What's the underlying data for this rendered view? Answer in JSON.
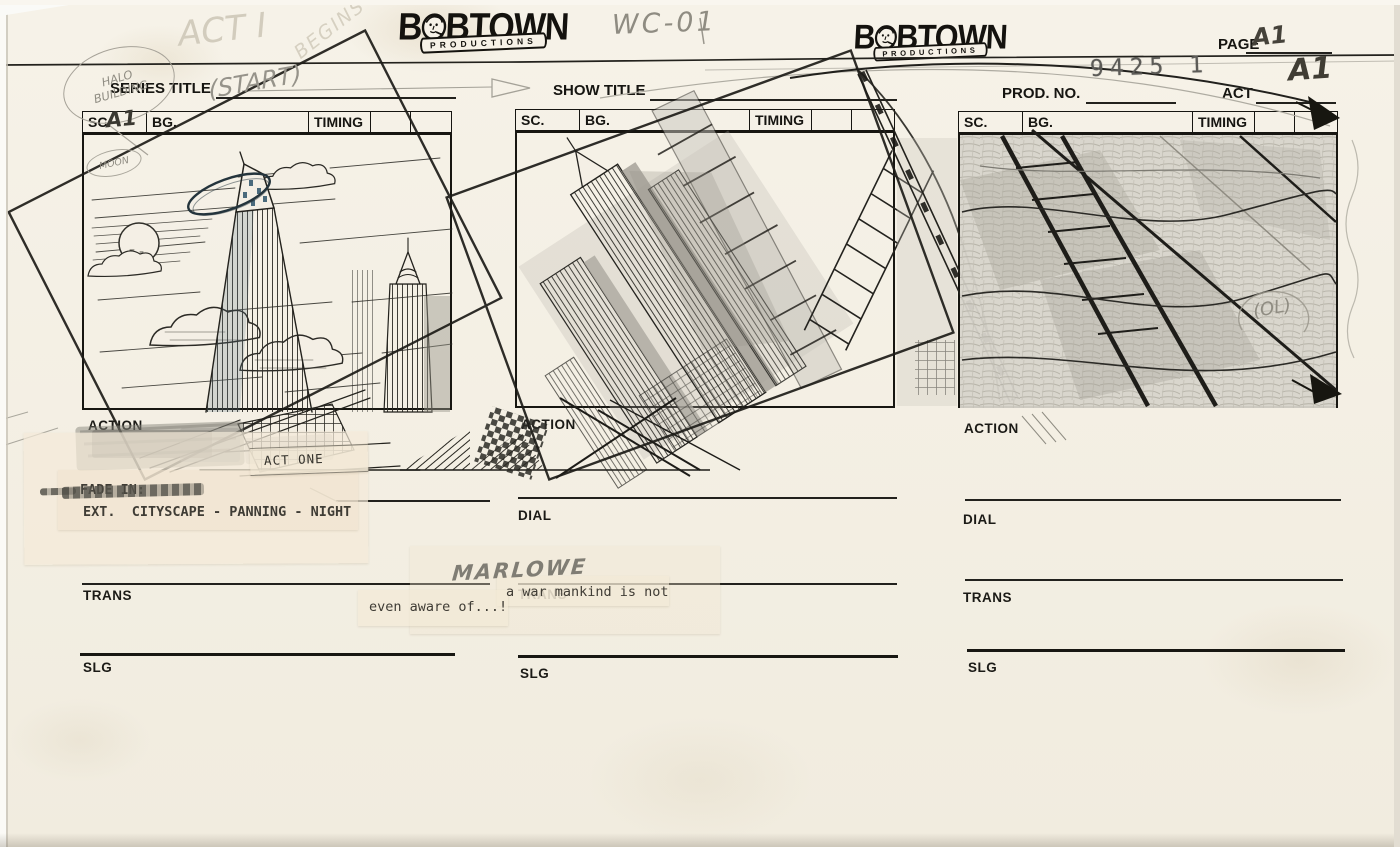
{
  "document": {
    "production_code": "WC-01",
    "page_label": "PAGE",
    "page_number": "A1",
    "series_title_label": "SERIES TITLE",
    "show_title_label": "SHOW TITLE",
    "prod_no_label": "PROD. NO.",
    "prod_no_value": "9425 1",
    "act_label": "ACT",
    "act_value": "A1"
  },
  "logo": {
    "prefix": "B",
    "suffix": "BTOWN",
    "banner": "PRODUCTIONS"
  },
  "panels": [
    {
      "sc_label": "SC.",
      "sc_value": "A1",
      "bg_label": "BG.",
      "timing_label": "TIMING",
      "action_label": "ACTION",
      "trans_label": "TRANS",
      "slg_label": "SLG"
    },
    {
      "sc_label": "SC.",
      "sc_value": "",
      "bg_label": "BG.",
      "timing_label": "TIMING",
      "action_label": "ACTION",
      "dial_label": "DIAL",
      "trans_label": "TRANS",
      "slg_label": "SLG"
    },
    {
      "sc_label": "SC.",
      "sc_value": "",
      "bg_label": "BG.",
      "timing_label": "TIMING",
      "action_label": "ACTION",
      "dial_label": "DIAL",
      "trans_label": "TRANS",
      "slg_label": "SLG"
    }
  ],
  "handwritten": {
    "note_halo_line1": "HALO",
    "note_halo_line2": "BUILDING",
    "note_act_line1": "ACT I",
    "note_act_line2": "BEGINS",
    "note_start": "(START)",
    "note_moon": "MOON",
    "character": "MARLOWE",
    "note_ol": "(OL)"
  },
  "typed": {
    "transition": "FADE IN:",
    "scene_heading": "EXT.  CITYSCAPE - PANNING - NIGHT",
    "act_title": "ACT ONE",
    "dialogue_line1": "a war mankind is not",
    "dialogue_line2": "even aware of...!"
  },
  "colors": {
    "paper": "#f4efe5",
    "ink": "#1c1b17",
    "pencil": "#8f8c82",
    "tape": "#f0e6d3",
    "halo_blue": "#4a6a7c"
  }
}
